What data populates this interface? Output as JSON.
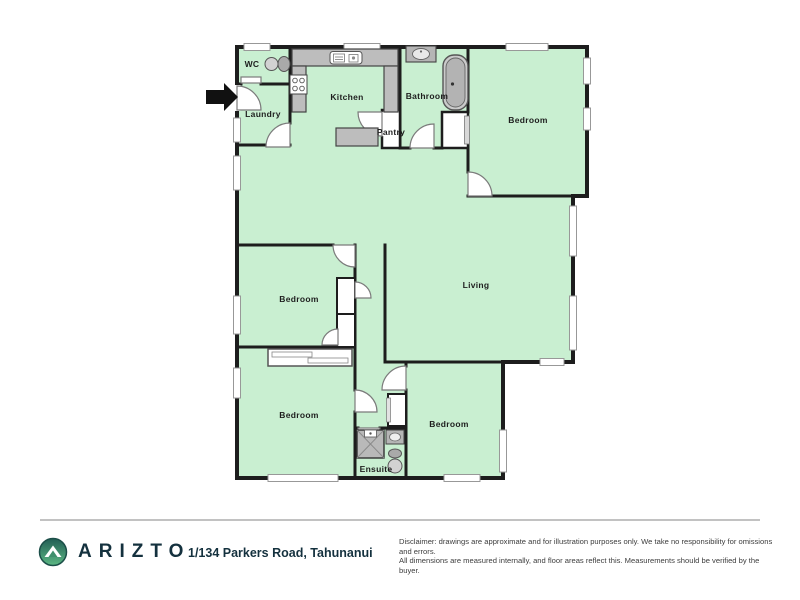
{
  "floorplan": {
    "rooms": {
      "wc": "WC",
      "laundry": "Laundry",
      "kitchen": "Kitchen",
      "pantry": "Pantry",
      "bathroom": "Bathroom",
      "bedroom_top_right": "Bedroom",
      "living": "Living",
      "bedroom_mid_left": "Bedroom",
      "bedroom_bottom_left": "Bedroom",
      "bedroom_bottom_right": "Bedroom",
      "ensuite": "Ensuite"
    },
    "colors": {
      "floor_green": "#c9efd1",
      "wall": "#1d1d1d",
      "fixture_gray": "#bdbdbd",
      "brand_navy": "#14313e",
      "logo_teal": "#225e55",
      "logo_green": "#5cb883"
    }
  },
  "footer": {
    "brand": "ARIZTO",
    "address": "1/134 Parkers Road, Tahunanui",
    "disclaimer_line1": "Disclaimer: drawings are approximate and for illustration purposes only. We take no responsibility for omissions and errors.",
    "disclaimer_line2": "All dimensions are measured internally, and floor areas reflect this. Measurements should be verified by the buyer."
  }
}
